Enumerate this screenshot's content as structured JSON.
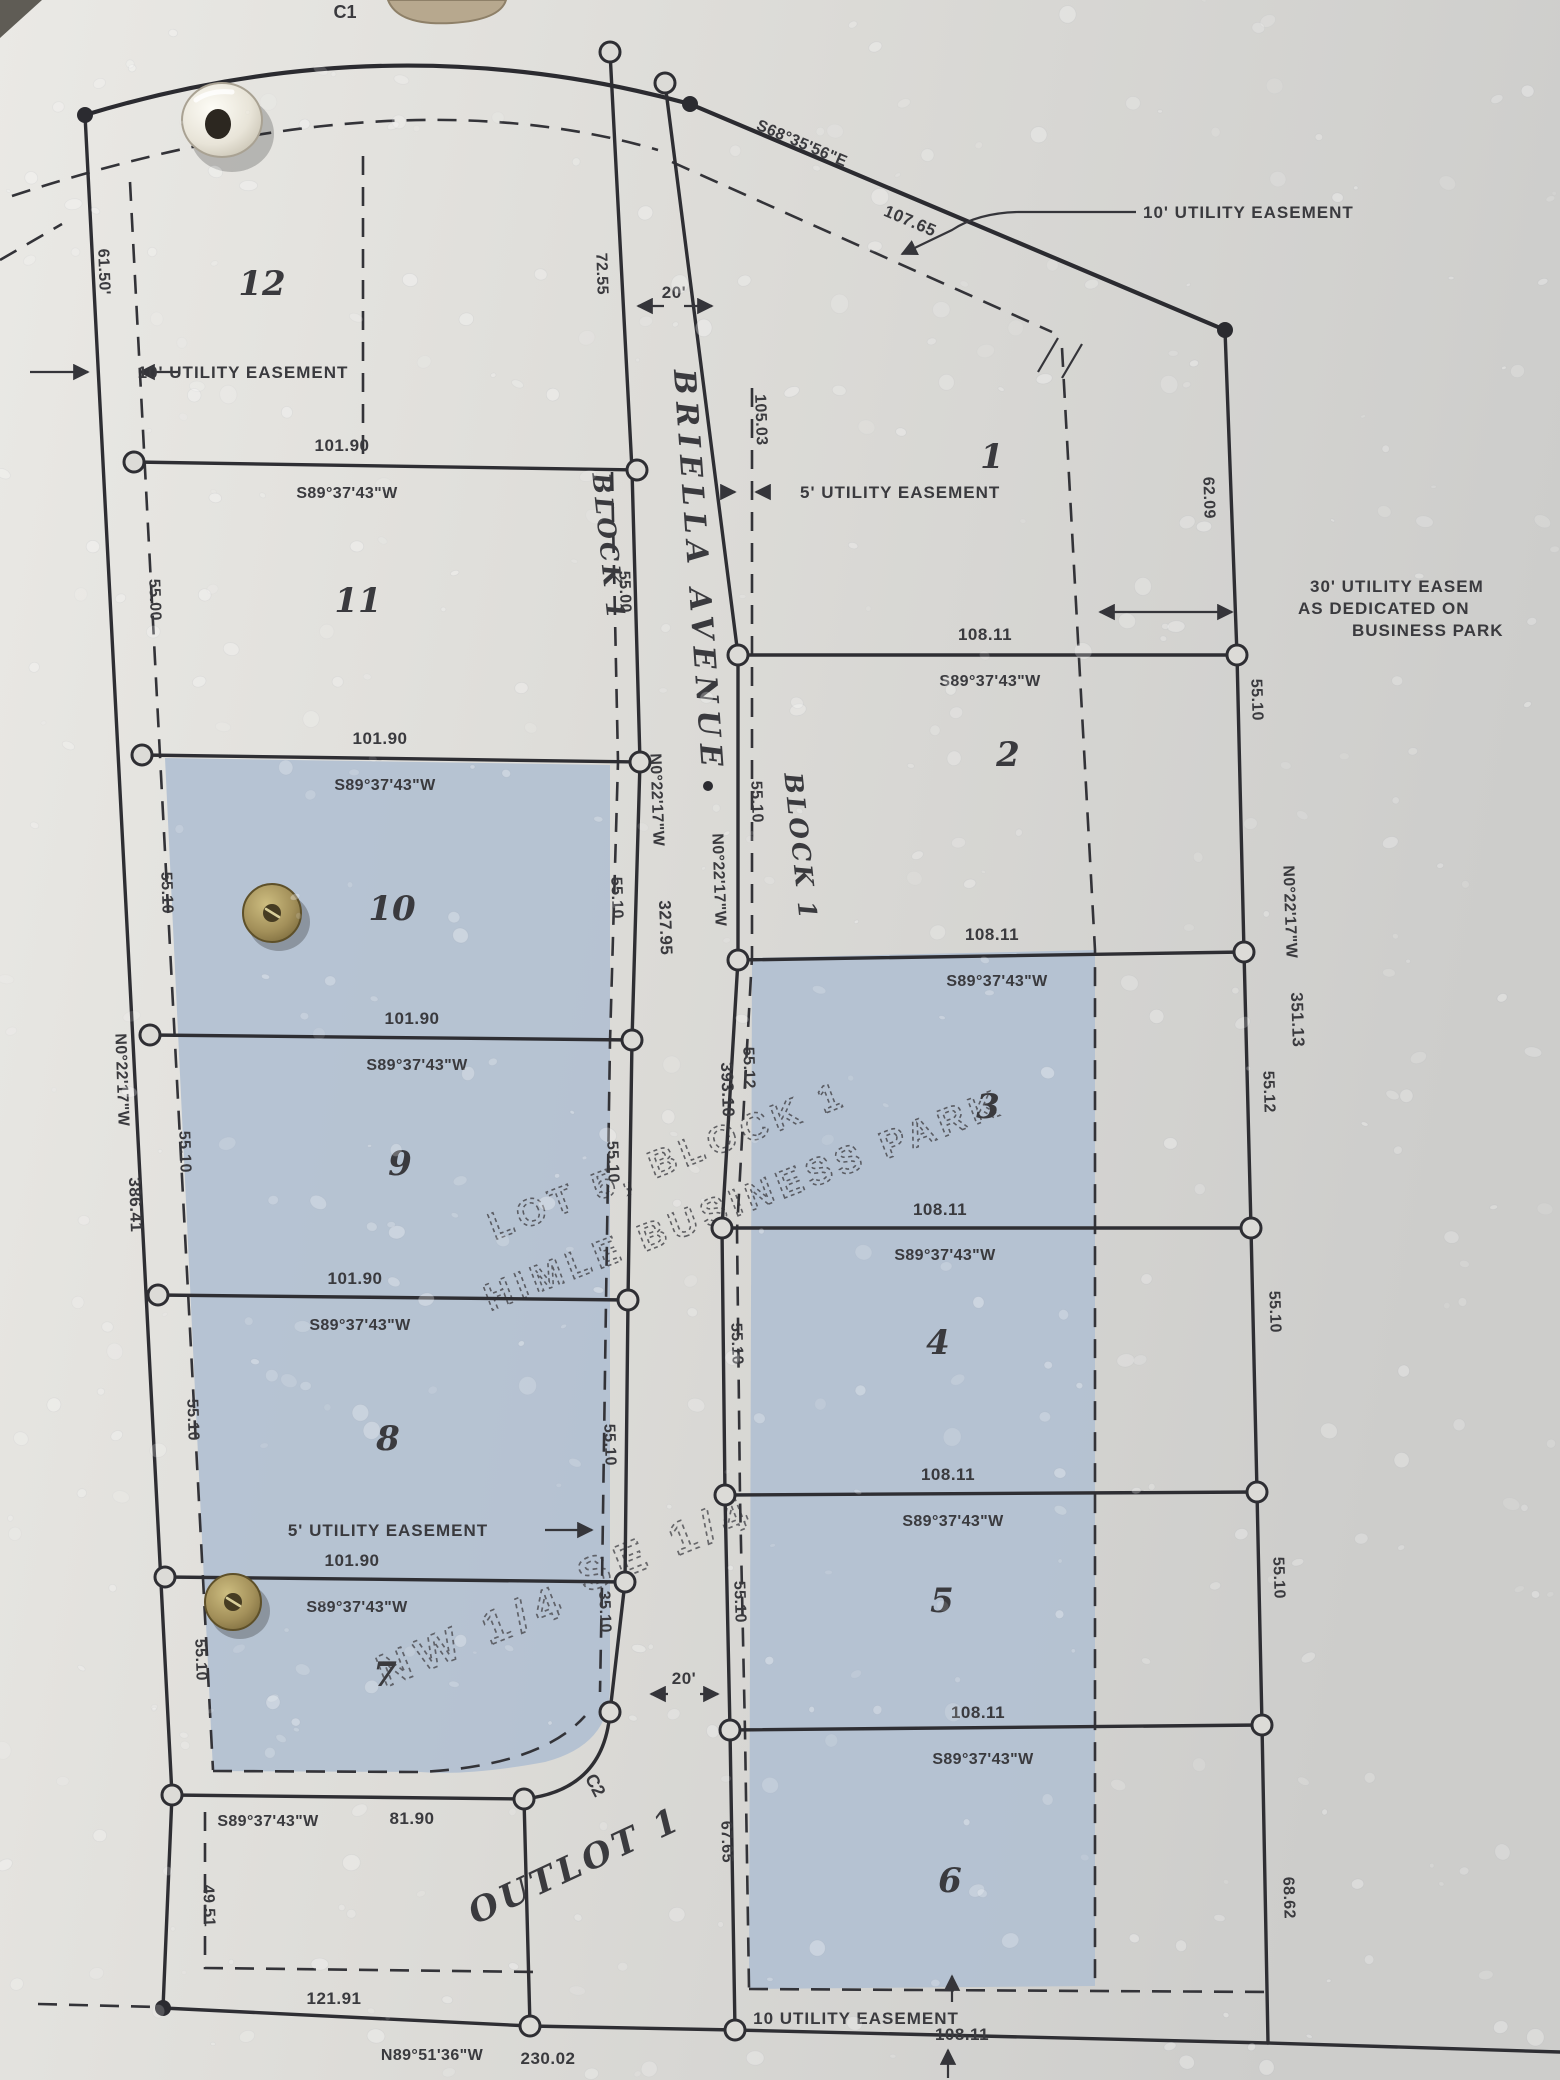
{
  "map": {
    "street_name": "BRIELLA AVENUE",
    "block_label": "BLOCK 1",
    "outlot_label": "OUTLOT 1",
    "curve_labels": {
      "c1": "C1",
      "c2": "C2"
    },
    "watermark": {
      "line1": "LOT 5, BLOCK 1",
      "line2": "HIMLE BUSINESS PARK",
      "nw_quarter": "NW 1/4",
      "se_quarter": "SE 1/4"
    },
    "lot_numbers": {
      "west": [
        "12",
        "11",
        "10",
        "9",
        "8",
        "7"
      ],
      "east": [
        "1",
        "2",
        "3",
        "4",
        "5",
        "6"
      ]
    },
    "bearings": {
      "west_lots": "S89°37'43\"W",
      "north_south": "N0°22'17\"W",
      "top_diagonal": "S68°35'56\"E",
      "bottom": "N89°51'36\"W"
    },
    "dimensions": {
      "top_diagonal_length": "107.65",
      "west_lot_width": "101.90",
      "east_lot_width": "108.11",
      "outlot_top_length": "81.90",
      "west_boundary_total": "386.41",
      "west_row_total": "327.95",
      "east_row_total": "393.10",
      "east_boundary_total": "351.13",
      "bottom_left_length": "121.91",
      "bottom_total": "230.02",
      "bottom_right_length": "108.11",
      "road_width_top": "20'",
      "road_width_bottom": "20'",
      "west_edge_segments": [
        "61.50'",
        "55.00",
        "55.10",
        "55.10",
        "55.10",
        "55.10",
        "49.51"
      ],
      "west_row_segments": [
        "72.55",
        "55.00",
        "55.10",
        "55.10",
        "55.10",
        "35.10"
      ],
      "east_row_segments": [
        "105.03",
        "55.10",
        "55.12",
        "55.10",
        "55.10",
        "67.65"
      ],
      "east_edge_segments": [
        "62.09",
        "55.10",
        "55.12",
        "55.10",
        "55.10",
        "68.62"
      ]
    },
    "easements": {
      "ten_ft": "10' UTILITY EASEMENT",
      "five_ft": "5' UTILITY EASEMENT",
      "ten_bottom": "10 UTILITY EASEMENT",
      "thirty_line1": "30' UTILITY EASEM",
      "thirty_line2": "AS DEDICATED ON",
      "thirty_line3": "BUSINESS PARK"
    }
  }
}
